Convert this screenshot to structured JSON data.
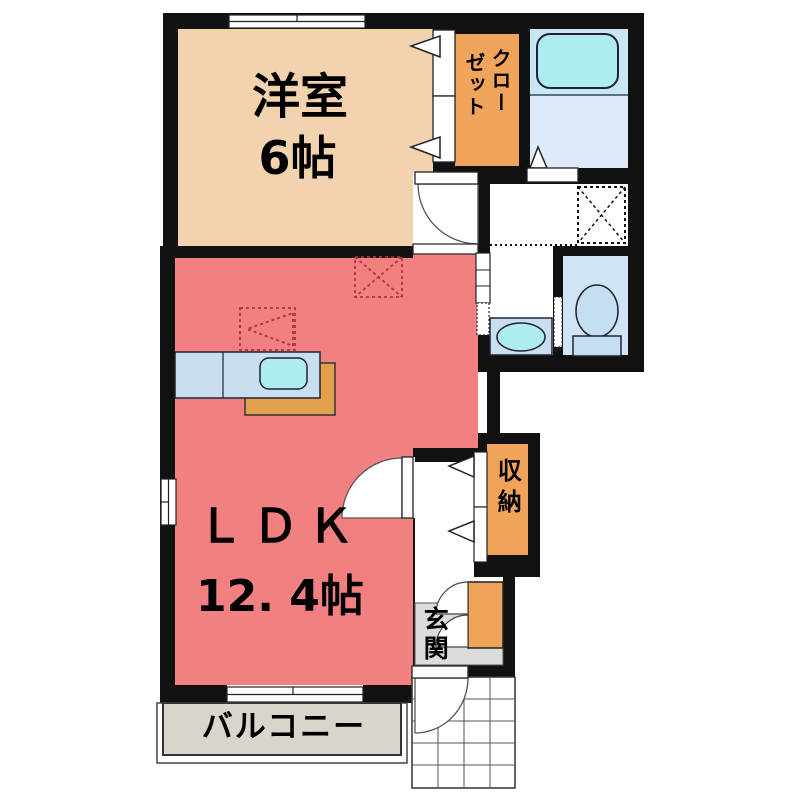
{
  "floorplan": {
    "labels": {
      "western_room": "洋室",
      "western_room_size": "6帖",
      "closet_col_right": "クロー",
      "closet_col_left": "ゼット",
      "ldk": "ＬＤＫ",
      "ldk_size": "12. 4帖",
      "storage": "収納",
      "entrance": "玄関",
      "balcony": "バルコニー"
    },
    "colors": {
      "wall": "#111111",
      "western_room": "#F2D3AE",
      "ldk": "#F28080",
      "closet_orange": "#F0A459",
      "kitchen_mat": "#E2A04E",
      "bath_upper": "#C9E6F4",
      "bath_lower": "#DDEBF8",
      "toilet_room": "#CFE4F7",
      "fixture_blue": "#C4DFF2",
      "cyan_fixture": "#AEECF2",
      "counter_blue": "#C8DFF2",
      "entrance_grey": "#DCDCDC",
      "balcony_grey": "#D9D4CC",
      "dashed_marker_red": "#B03232",
      "floor_white": "#FFFFFF"
    }
  }
}
